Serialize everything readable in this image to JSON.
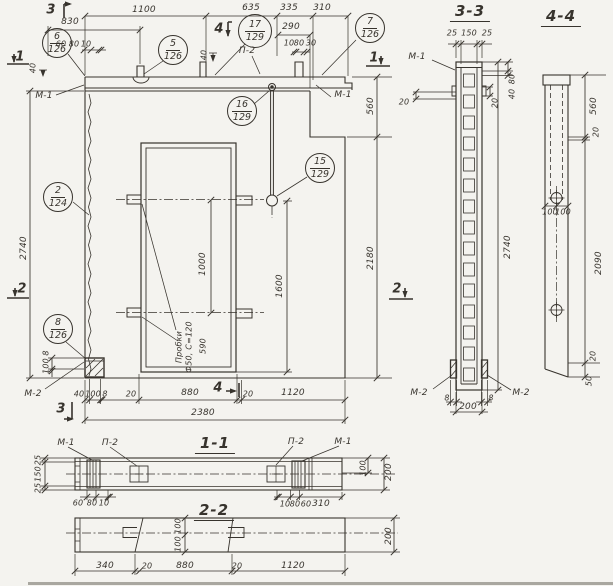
{
  "main": {
    "callouts": {
      "c6": {
        "num": "6",
        "sheet": "126"
      },
      "c5": {
        "num": "5",
        "sheet": "126"
      },
      "c17": {
        "num": "17",
        "sheet": "129"
      },
      "c7": {
        "num": "7",
        "sheet": "126"
      },
      "c16": {
        "num": "16",
        "sheet": "129"
      },
      "c15": {
        "num": "15",
        "sheet": "129"
      },
      "c2": {
        "num": "2",
        "sheet": "124"
      },
      "c8": {
        "num": "8",
        "sheet": "126"
      }
    },
    "labels": {
      "m1_left": "М-1",
      "p2": "П-2",
      "m1_right": "М-1",
      "m2": "М-2",
      "note1": "Пробки",
      "note2": "Ф50, С=120",
      "note_dim": "590"
    },
    "markers": {
      "s3_top": "3",
      "s4_top": "4",
      "s1_left": "1",
      "s2_left": "2",
      "s1_right": "1",
      "s2_right": "2",
      "s3_bottom": "3",
      "s4_bottom": "4"
    },
    "dims": {
      "t1100": "1100",
      "t830": "830",
      "t635": "635",
      "t335": "335",
      "t310": "310",
      "t290": "290",
      "g60": "60",
      "g80": "80",
      "g10": "10",
      "h10": "10",
      "h80": "80",
      "h30": "30",
      "v40l": "40",
      "v40m": "40",
      "left2740": "2740",
      "r560": "560",
      "r2180": "2180",
      "o1000": "1000",
      "r1600": "1600",
      "bl100": "100",
      "bl8": "8",
      "b40": "40",
      "b100": "100",
      "b8": "8",
      "b20a": "20",
      "b880": "880",
      "b20b": "20",
      "b1120": "1120",
      "total": "2380"
    }
  },
  "section33": {
    "title": "3-3",
    "m1": "М-1",
    "m2l": "М-2",
    "m2r": "М-2",
    "d25a": "25",
    "d150": "150",
    "d25b": "25",
    "d20l": "20",
    "d20r": "20",
    "d80": "80",
    "d40": "40",
    "d2740": "2740",
    "d8l": "8",
    "d8r": "8",
    "d200": "200"
  },
  "section44": {
    "title": "4-4",
    "d560": "560",
    "d20t": "20",
    "d100a": "100",
    "d100b": "100",
    "d2090": "2090",
    "d20b": "20",
    "d50": "50"
  },
  "section11": {
    "title": "1-1",
    "m1l": "М-1",
    "p2l": "П-2",
    "p2r": "П-2",
    "m1r": "М-1",
    "d25a": "25",
    "d150": "150",
    "d25b": "25",
    "d60": "60",
    "d80": "80",
    "d10": "10",
    "r10": "10",
    "r80": "80",
    "r60": "60",
    "r310": "310",
    "v100": "100",
    "v200": "200"
  },
  "section22": {
    "title": "2-2",
    "v100a": "100",
    "v100b": "100",
    "d340": "340",
    "d20a": "20",
    "d880": "880",
    "d20b": "20",
    "d1120": "1120",
    "r200": "200"
  }
}
